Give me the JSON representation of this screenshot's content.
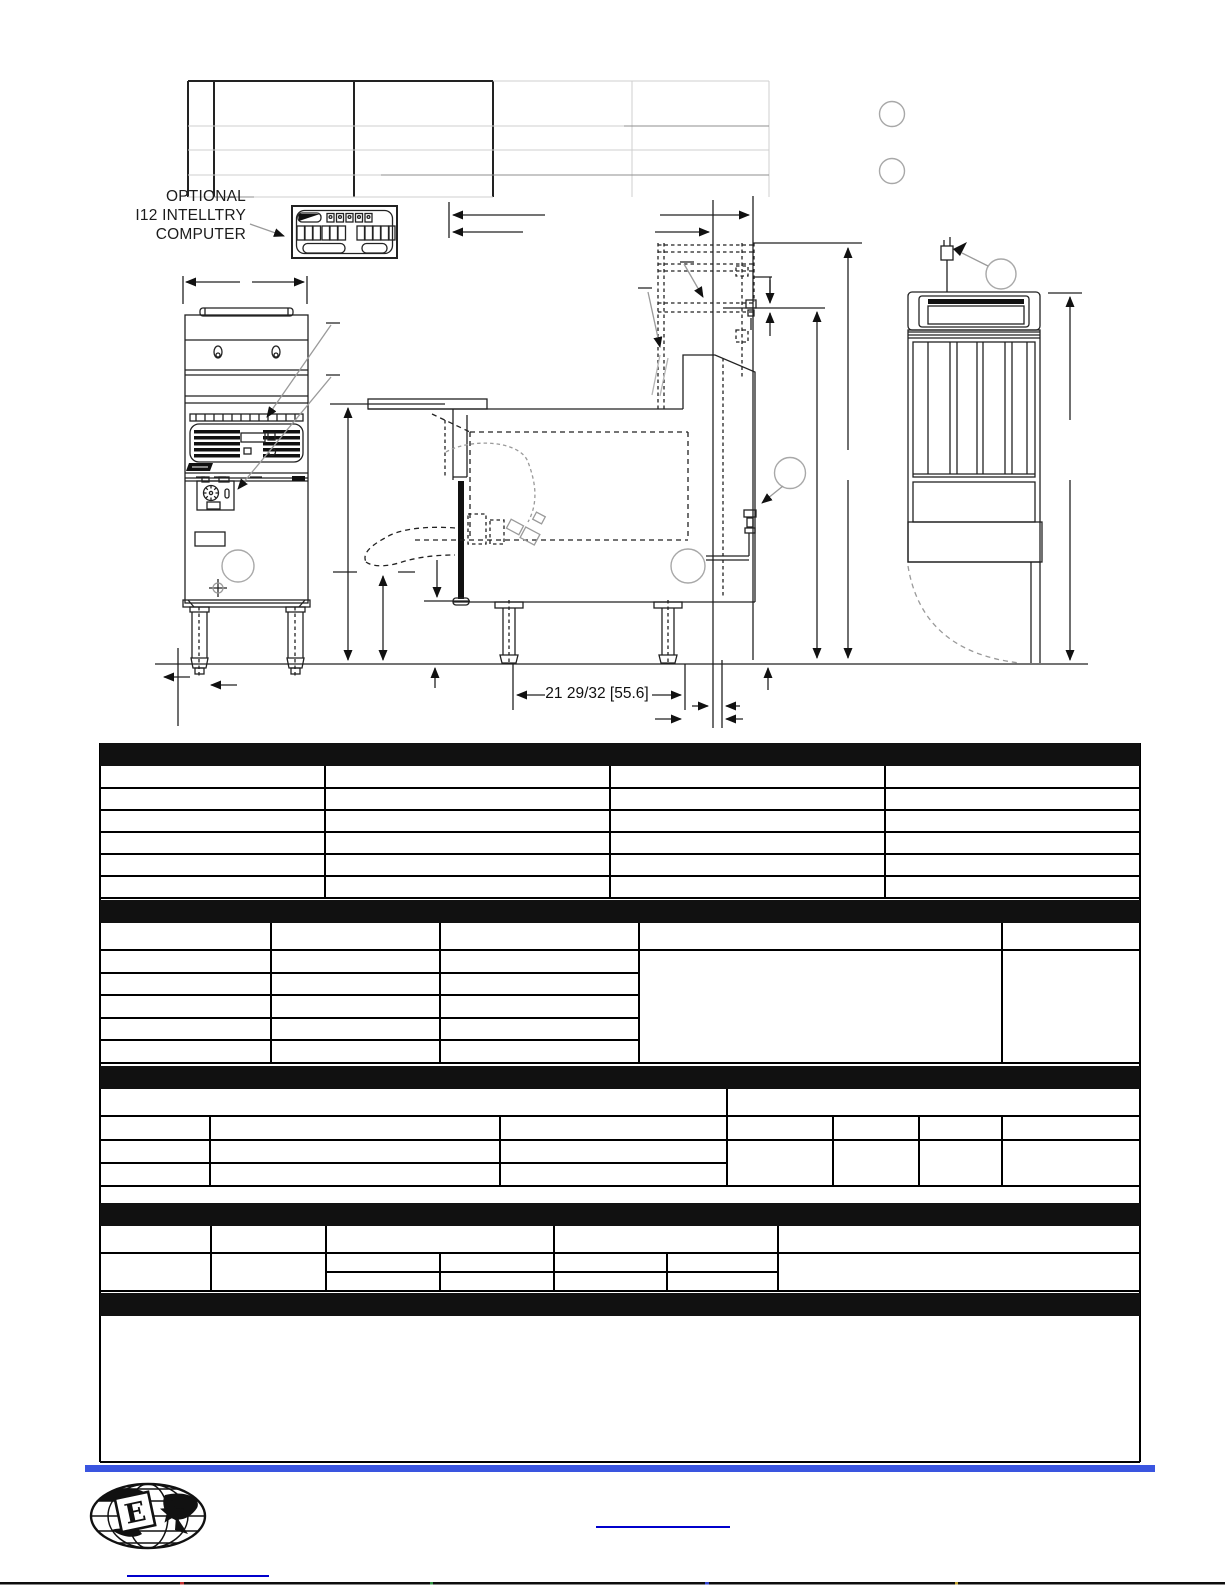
{
  "page": {
    "width": 1225,
    "height": 1585,
    "background": "#ffffff"
  },
  "colors": {
    "drawing_line": "#222222",
    "table_line": "#000000",
    "light_table_line": "#cfcfcf",
    "medium_table_line": "#8f8f8f",
    "callout_circle_gray": "#a8a8a8",
    "section_header_bar": "#000000",
    "footer_accent_bar": "#3a55e0",
    "link": "#0000cc"
  },
  "drawing_labels": {
    "optional_computer_line1": "OPTIONAL",
    "optional_computer_line2": "I12 INTELLTRY",
    "optional_computer_line3": "COMPUTER",
    "base_dimension": "21 29/32 [55.6]"
  },
  "icons": {
    "callout_circles": "empty-callout-circle-icon",
    "logo": "globe-with-letter-logo"
  },
  "logo": {
    "letter": "E"
  }
}
